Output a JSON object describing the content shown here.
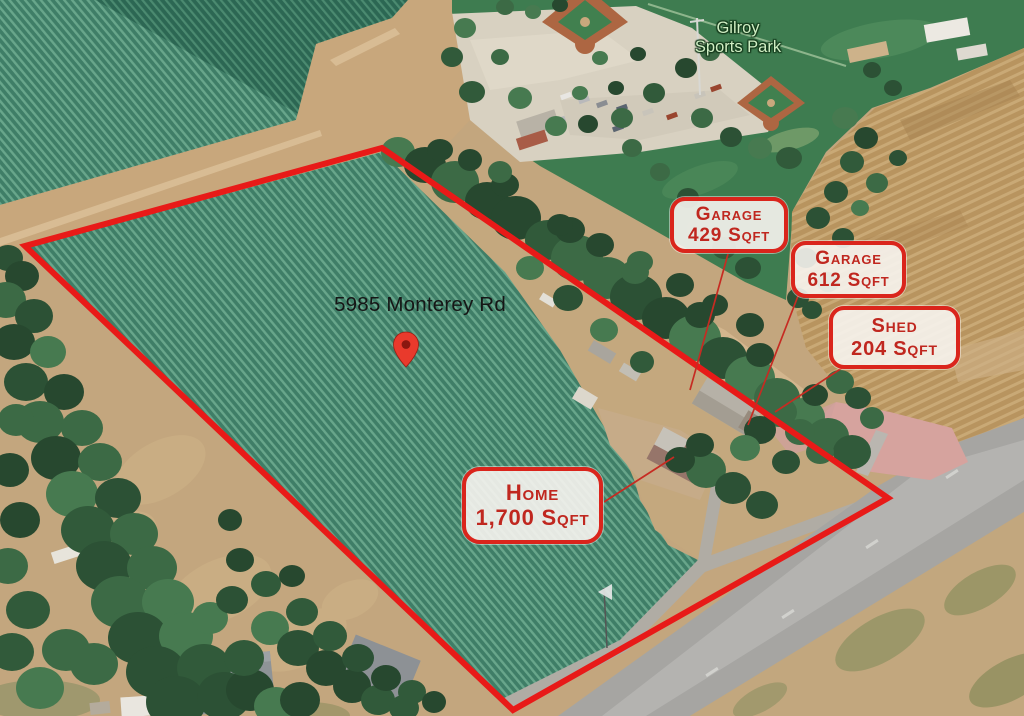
{
  "park_label": {
    "line1": "Gilroy",
    "line2": "Sports Park"
  },
  "address_pin": {
    "label": "5985 Monterey Rd"
  },
  "callouts": {
    "garage_429": {
      "name": "Garage",
      "area": "429 Sqft"
    },
    "garage_612": {
      "name": "Garage",
      "area": "612 Sqft"
    },
    "shed_204": {
      "name": "Shed",
      "area": "204 Sqft"
    },
    "home_1700": {
      "name": "Home",
      "area": "1,700 Sqft"
    }
  },
  "theme": {
    "boundary_red": "#e81a18",
    "leader_red": "#c62b22",
    "pin_red": "#e93a2c",
    "callout_text_red": "#c0271f",
    "callout_border_red": "#da251c",
    "callout_bg": "rgba(247,244,239,0.9)",
    "address_text": "#161616",
    "park_label_green": "#cfeec3"
  }
}
